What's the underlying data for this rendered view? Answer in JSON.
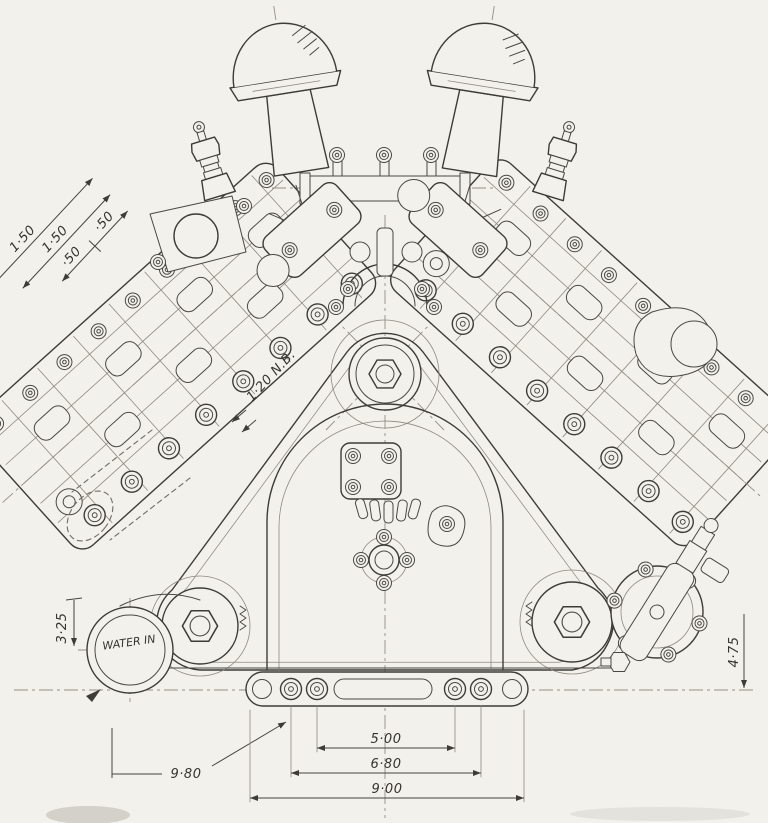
{
  "colors": {
    "paper": "#f3f1ec",
    "ink": "#3e3c37",
    "light_ink": "#8d897f",
    "centerline": "#938f84"
  },
  "labels": {
    "dim_bank_pitch_outer": "1·50",
    "dim_bank_pitch_inner": "1·50",
    "dim_bank_half_a": "·50",
    "dim_bank_half_b": "·50",
    "pipe_bore": "1·20 N.B.",
    "dim_water_inlet_height": "3·25",
    "water_inlet": "WATER IN",
    "dim_base_left": "9·80",
    "dim_bolt_span_inner": "5·00",
    "dim_bolt_span_outer": "6·80",
    "dim_base_width": "9·00",
    "dim_pump_height": "4·75"
  }
}
